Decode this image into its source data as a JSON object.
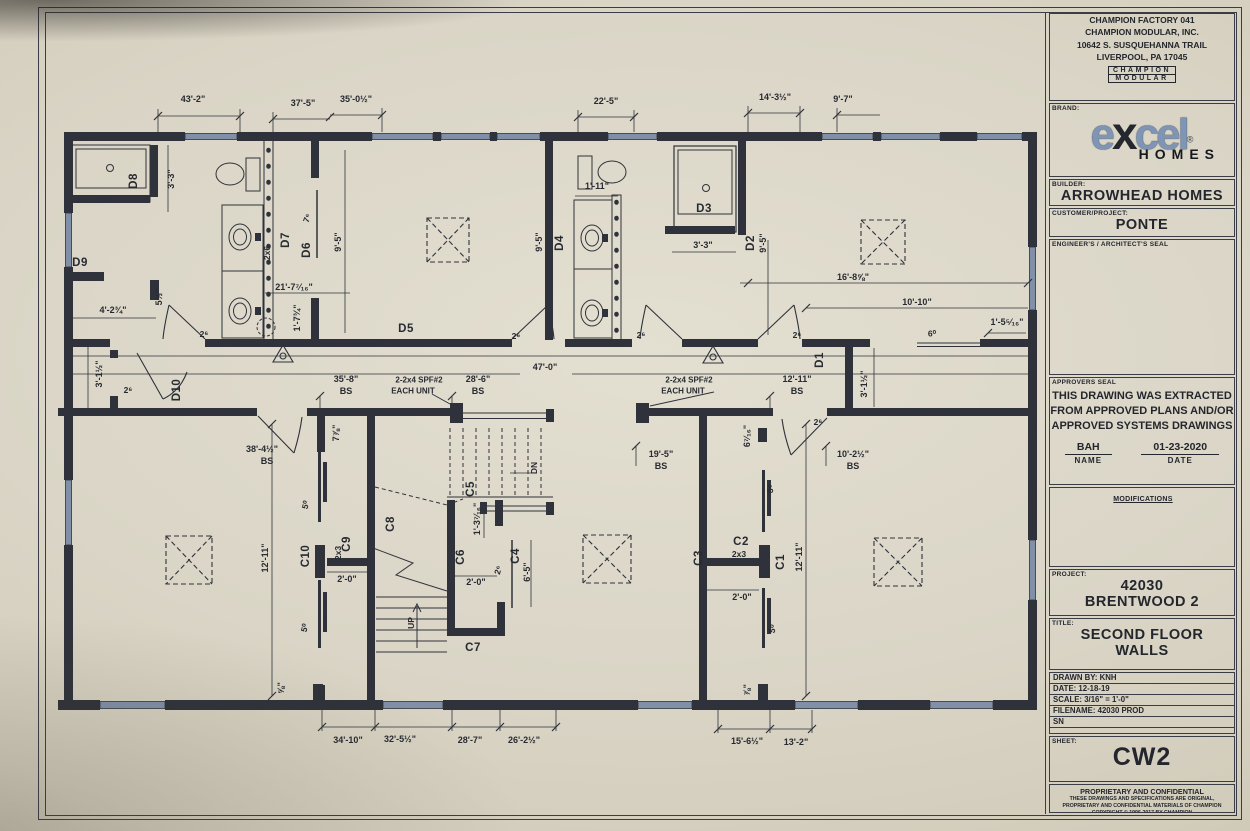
{
  "title_block": {
    "factory_lines": [
      "CHAMPION FACTORY 041",
      "CHAMPION MODULAR, INC.",
      "10642 S. SUSQUEHANNA TRAIL",
      "LIVERPOOL, PA  17045"
    ],
    "champion_logo_line1": "CHAMPION",
    "champion_logo_line2": "MODULAR",
    "brand_label": "BRAND:",
    "brand_name_e": "e",
    "brand_name_x": "x",
    "brand_name_cel": "cel",
    "brand_reg": "®",
    "brand_homes": "HOMES",
    "builder_label": "BUILDER:",
    "builder_name": "ARROWHEAD HOMES",
    "customer_label": "CUSTOMER/PROJECT:",
    "customer_name": "PONTE",
    "seal_label": "ENGINEER'S / ARCHITECT'S SEAL",
    "approver_seal_label": "APPROVERS SEAL",
    "approval_lines": [
      "THIS DRAWING WAS EXTRACTED",
      "FROM APPROVED PLANS AND/OR",
      "APPROVED SYSTEMS DRAWINGS"
    ],
    "approver_name": "BAH",
    "name_label": "NAME",
    "approval_date": "01-23-2020",
    "date_label": "DATE",
    "modifications_label": "MODIFICATIONS",
    "project_label": "PROJECT:",
    "project_number": "42030",
    "project_name": "BRENTWOOD 2",
    "title_label": "TITLE:",
    "title_line1": "SECOND FLOOR",
    "title_line2": "WALLS",
    "drawn_by": "DRAWN BY: KNH",
    "date": "DATE: 12-18-19",
    "scale": "SCALE: 3/16\" = 1'-0\"",
    "filename": "FILENAME: 42030 PROD",
    "sn": "SN",
    "sheet_label": "SHEET:",
    "sheet_number": "CW2",
    "conf_title": "PROPRIETARY AND CONFIDENTIAL",
    "conf_line1": "THESE DRAWINGS AND SPECIFICATIONS ARE ORIGINAL,",
    "conf_line2": "PROPRIETARY AND CONFIDENTIAL MATERIALS OF CHAMPION",
    "copyright": "COPYRIGHT © 1996-2017 BY CHAMPION"
  },
  "plan": {
    "labels": [
      {
        "t": "43'-2\"",
        "x": 193,
        "y": 99,
        "c": "dim"
      },
      {
        "t": "37'-5\"",
        "x": 303,
        "y": 103,
        "c": "dim"
      },
      {
        "t": "35'-0½\"",
        "x": 356,
        "y": 99,
        "c": "dim"
      },
      {
        "t": "22'-5\"",
        "x": 606,
        "y": 101,
        "c": "dim"
      },
      {
        "t": "14'-3½\"",
        "x": 775,
        "y": 97,
        "c": "dim"
      },
      {
        "t": "9'-7\"",
        "x": 843,
        "y": 99,
        "c": "dim"
      },
      {
        "t": "34'-10\"",
        "x": 348,
        "y": 740,
        "c": "dim"
      },
      {
        "t": "32'-5½\"",
        "x": 400,
        "y": 739,
        "c": "dim"
      },
      {
        "t": "28'-7\"",
        "x": 470,
        "y": 740,
        "c": "dim"
      },
      {
        "t": "26'-2½\"",
        "x": 524,
        "y": 740,
        "c": "dim"
      },
      {
        "t": "15'-6½\"",
        "x": 747,
        "y": 741,
        "c": "dim"
      },
      {
        "t": "13'-2\"",
        "x": 796,
        "y": 742,
        "c": "dim"
      },
      {
        "t": "D8",
        "x": 134,
        "y": 181,
        "r": -90,
        "c": "tag"
      },
      {
        "t": "3'-3\"",
        "x": 171,
        "y": 179,
        "r": -90,
        "c": "dim"
      },
      {
        "t": "D9",
        "x": 80,
        "y": 263,
        "c": "tag"
      },
      {
        "t": "4'-2¾\"",
        "x": 113,
        "y": 310,
        "c": "dim"
      },
      {
        "t": "5½\"",
        "x": 159,
        "y": 297,
        "r": -90,
        "c": "dim"
      },
      {
        "t": "3'-1½\"",
        "x": 99,
        "y": 374,
        "r": -90,
        "c": "dim"
      },
      {
        "t": "D10",
        "x": 177,
        "y": 390,
        "r": -90,
        "c": "tag"
      },
      {
        "t": "2⁶",
        "x": 128,
        "y": 390,
        "c": "tiny"
      },
      {
        "t": "2⁶",
        "x": 204,
        "y": 334,
        "c": "tiny"
      },
      {
        "t": "21'-7⁷⁄₁₆\"",
        "x": 294,
        "y": 287,
        "c": "dim"
      },
      {
        "t": "1'-7¾\"",
        "x": 297,
        "y": 318,
        "r": -90,
        "c": "dim"
      },
      {
        "t": "2x6",
        "x": 267,
        "y": 253,
        "r": -90,
        "c": "tiny"
      },
      {
        "t": "D7",
        "x": 286,
        "y": 240,
        "r": -90,
        "c": "tag"
      },
      {
        "t": "D6",
        "x": 307,
        "y": 250,
        "r": -90,
        "c": "tag"
      },
      {
        "t": "7⁶",
        "x": 307,
        "y": 218,
        "r": -70,
        "c": "tiny"
      },
      {
        "t": "9'-5\"",
        "x": 338,
        "y": 242,
        "r": -90,
        "c": "dim"
      },
      {
        "t": "D5",
        "x": 406,
        "y": 329,
        "c": "tag"
      },
      {
        "t": "2⁶",
        "x": 516,
        "y": 336,
        "c": "tiny"
      },
      {
        "t": "47'-0\"",
        "x": 545,
        "y": 367,
        "c": "dim"
      },
      {
        "t": "9'-5\"",
        "x": 539,
        "y": 242,
        "r": -90,
        "c": "dim"
      },
      {
        "t": "D4",
        "x": 560,
        "y": 243,
        "r": -90,
        "c": "tag"
      },
      {
        "t": "1'-11\"",
        "x": 597,
        "y": 186,
        "c": "dim"
      },
      {
        "t": "D3",
        "x": 704,
        "y": 209,
        "c": "tag"
      },
      {
        "t": "3'-3\"",
        "x": 703,
        "y": 245,
        "c": "dim"
      },
      {
        "t": "D2",
        "x": 751,
        "y": 243,
        "r": -90,
        "c": "tag"
      },
      {
        "t": "9'-5\"",
        "x": 763,
        "y": 243,
        "r": -90,
        "c": "dim"
      },
      {
        "t": "2⁶",
        "x": 641,
        "y": 335,
        "c": "tiny"
      },
      {
        "t": "2⁶",
        "x": 797,
        "y": 335,
        "c": "tiny"
      },
      {
        "t": "16'-8⅝\"",
        "x": 853,
        "y": 277,
        "c": "dim"
      },
      {
        "t": "10'-10\"",
        "x": 917,
        "y": 302,
        "c": "dim"
      },
      {
        "t": "6⁰",
        "x": 932,
        "y": 334,
        "c": "tiny"
      },
      {
        "t": "1'-5⁵⁄₁₆\"",
        "x": 1007,
        "y": 322,
        "c": "dim"
      },
      {
        "t": "D1",
        "x": 820,
        "y": 360,
        "r": -90,
        "c": "tag"
      },
      {
        "t": "3'-1½\"",
        "x": 864,
        "y": 384,
        "r": -90,
        "c": "dim"
      },
      {
        "t": "2⁶",
        "x": 818,
        "y": 422,
        "c": "tiny"
      },
      {
        "t": "35'-8\"",
        "x": 346,
        "y": 379,
        "c": "dim"
      },
      {
        "t": "BS",
        "x": 346,
        "y": 391,
        "c": "dim"
      },
      {
        "t": "2-2x4 SPF#2",
        "x": 419,
        "y": 380,
        "c": "note"
      },
      {
        "t": "EACH UNIT",
        "x": 413,
        "y": 391,
        "c": "note"
      },
      {
        "t": "28'-6\"",
        "x": 478,
        "y": 379,
        "c": "dim"
      },
      {
        "t": "BS",
        "x": 478,
        "y": 391,
        "c": "dim"
      },
      {
        "t": "2-2x4 SPF#2",
        "x": 689,
        "y": 380,
        "c": "note"
      },
      {
        "t": "EACH UNIT",
        "x": 683,
        "y": 391,
        "c": "note"
      },
      {
        "t": "12'-11\"",
        "x": 797,
        "y": 379,
        "c": "dim"
      },
      {
        "t": "BS",
        "x": 797,
        "y": 391,
        "c": "dim"
      },
      {
        "t": "38'-4½\"",
        "x": 262,
        "y": 449,
        "c": "dim"
      },
      {
        "t": "BS",
        "x": 267,
        "y": 461,
        "c": "dim"
      },
      {
        "t": "7⅞\"",
        "x": 336,
        "y": 433,
        "r": -90,
        "c": "dim"
      },
      {
        "t": "19'-5\"",
        "x": 661,
        "y": 454,
        "c": "dim"
      },
      {
        "t": "BS",
        "x": 661,
        "y": 466,
        "c": "dim"
      },
      {
        "t": "6⁷⁄₁₆\"",
        "x": 747,
        "y": 436,
        "r": -90,
        "c": "dim"
      },
      {
        "t": "10'-2½\"",
        "x": 853,
        "y": 454,
        "c": "dim"
      },
      {
        "t": "BS",
        "x": 853,
        "y": 466,
        "c": "dim"
      },
      {
        "t": "12'-11\"",
        "x": 265,
        "y": 558,
        "r": -90,
        "c": "dim"
      },
      {
        "t": "5⁰",
        "x": 306,
        "y": 505,
        "r": -75,
        "c": "tiny"
      },
      {
        "t": "C10",
        "x": 306,
        "y": 556,
        "r": -90,
        "c": "tag"
      },
      {
        "t": "C9",
        "x": 347,
        "y": 544,
        "r": -90,
        "c": "tag"
      },
      {
        "t": "2x3",
        "x": 338,
        "y": 553,
        "r": -90,
        "c": "tiny"
      },
      {
        "t": "2'-0\"",
        "x": 347,
        "y": 579,
        "c": "dim"
      },
      {
        "t": "5⁰",
        "x": 305,
        "y": 628,
        "r": -75,
        "c": "tiny"
      },
      {
        "t": "C8",
        "x": 391,
        "y": 524,
        "r": -90,
        "c": "tag"
      },
      {
        "t": "C5",
        "x": 471,
        "y": 489,
        "r": -90,
        "c": "tag"
      },
      {
        "t": "1'-3⁷⁄₁₆\"",
        "x": 477,
        "y": 519,
        "r": -90,
        "c": "dim"
      },
      {
        "t": "DN",
        "x": 534,
        "y": 468,
        "r": -90,
        "c": "tiny"
      },
      {
        "t": "C6",
        "x": 461,
        "y": 557,
        "r": -90,
        "c": "tag"
      },
      {
        "t": "C4",
        "x": 516,
        "y": 556,
        "r": -90,
        "c": "tag"
      },
      {
        "t": "2⁶",
        "x": 498,
        "y": 570,
        "r": -75,
        "c": "tiny"
      },
      {
        "t": "6'-5\"",
        "x": 527,
        "y": 572,
        "r": -90,
        "c": "dim"
      },
      {
        "t": "2'-0\"",
        "x": 476,
        "y": 582,
        "c": "dim"
      },
      {
        "t": "C7",
        "x": 473,
        "y": 648,
        "c": "tag"
      },
      {
        "t": "UP",
        "x": 411,
        "y": 623,
        "r": -90,
        "c": "tiny"
      },
      {
        "t": "⅝\"",
        "x": 281,
        "y": 688,
        "r": -90,
        "c": "dim"
      },
      {
        "t": "C3",
        "x": 699,
        "y": 558,
        "r": -90,
        "c": "tag"
      },
      {
        "t": "C2",
        "x": 741,
        "y": 542,
        "c": "tag"
      },
      {
        "t": "2x3",
        "x": 739,
        "y": 554,
        "c": "tiny"
      },
      {
        "t": "C1",
        "x": 781,
        "y": 562,
        "r": -90,
        "c": "tag"
      },
      {
        "t": "12'-11\"",
        "x": 799,
        "y": 557,
        "r": -90,
        "c": "dim"
      },
      {
        "t": "2'-0\"",
        "x": 742,
        "y": 597,
        "c": "dim"
      },
      {
        "t": "5⁰",
        "x": 771,
        "y": 489,
        "r": -75,
        "c": "tiny"
      },
      {
        "t": "5⁰",
        "x": 773,
        "y": 629,
        "r": -75,
        "c": "tiny"
      },
      {
        "t": "⅞\"",
        "x": 747,
        "y": 690,
        "r": -90,
        "c": "dim"
      }
    ]
  }
}
